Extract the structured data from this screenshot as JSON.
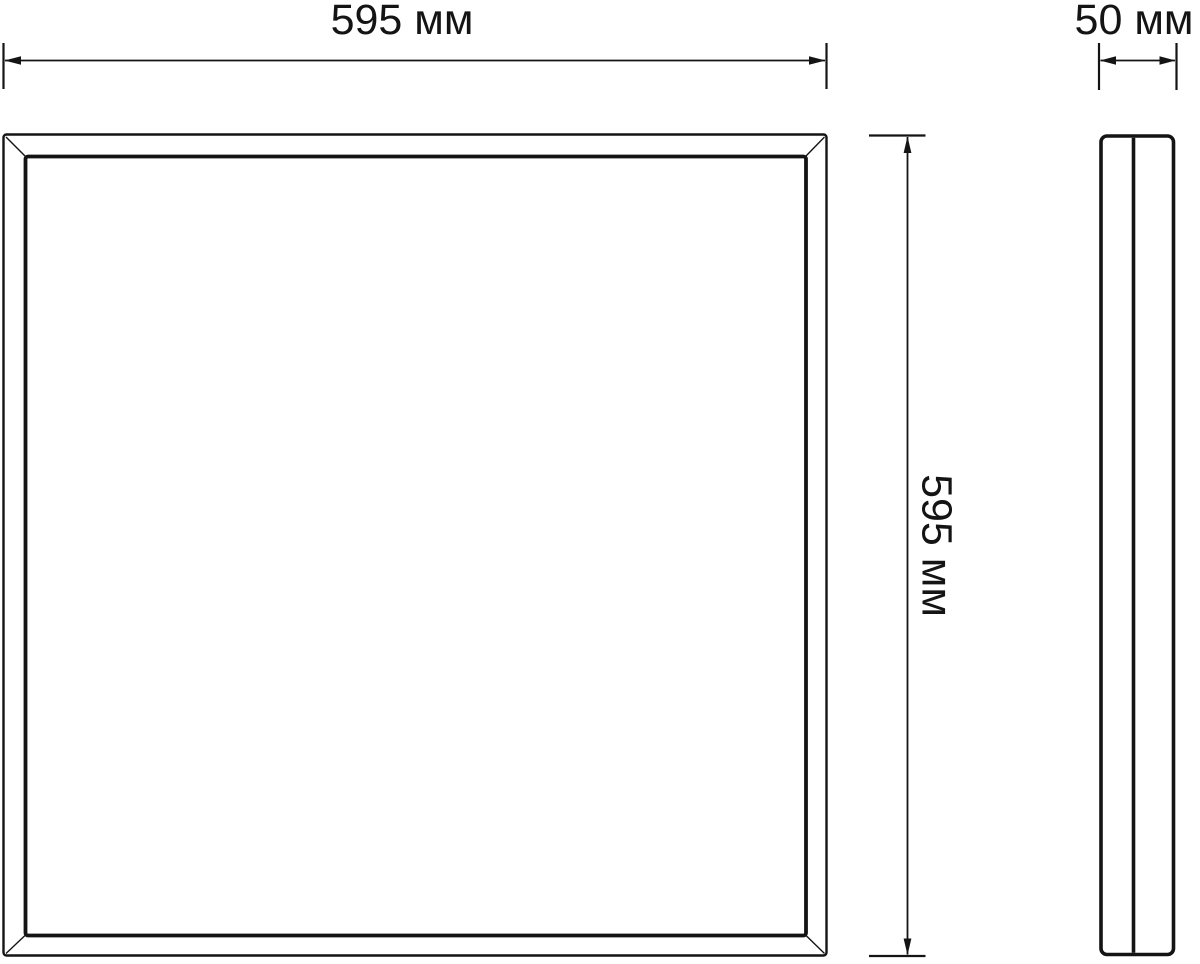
{
  "page": {
    "background_color": "#ffffff",
    "line_color": "#141414"
  },
  "dimensions": {
    "front_width": {
      "label": "595 мм",
      "value": 595,
      "unit": "мм"
    },
    "front_height": {
      "label": "595 мм",
      "value": 595,
      "unit": "мм"
    },
    "side_depth": {
      "label": "50 мм",
      "value": 50,
      "unit": "мм"
    }
  }
}
